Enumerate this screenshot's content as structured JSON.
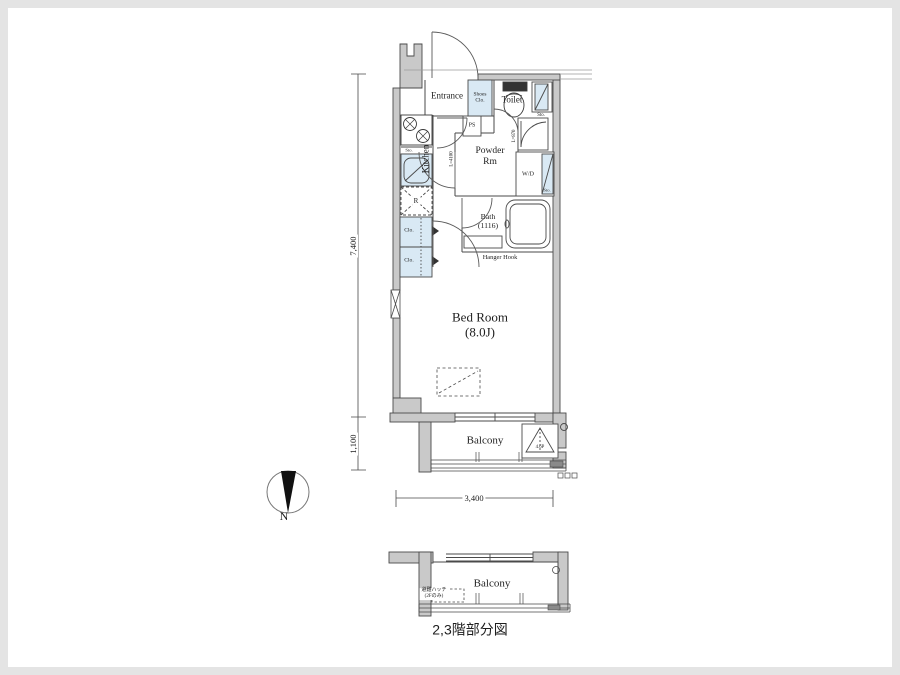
{
  "colors": {
    "wall": "#c9c9c9",
    "fixture": "#d9e9f4",
    "line": "#4a4a4a"
  },
  "main": {
    "entrance": "Entrance",
    "shoes_closet": "Shoes\nClo.",
    "toilet": "Toilet",
    "pipe_space": "PS",
    "storage_top": "Sto.",
    "storage_kitchen": "Sto.",
    "storage_wd": "Sto.",
    "kitchen": "Kitchen",
    "kitchen_length": "L=4100",
    "powder_room": "Powder\nRm",
    "washer_dryer": "W/D",
    "closet_length": "L=870",
    "bath": "Bath\n(1116)",
    "hanger_hook": "Hanger Hook",
    "closet_1": "Clo.",
    "closet_2": "Clo.",
    "refrigerator": "R",
    "bedroom": "Bed Room\n(8.0J)",
    "balcony": "Balcony",
    "hatch_label": "4.6P"
  },
  "dimensions": {
    "total_depth": "7,400",
    "balcony_depth": "1,100",
    "width": "3,400"
  },
  "compass": {
    "north": "N"
  },
  "lower": {
    "balcony": "Balcony",
    "hatch_note": "避難ハッチ\n(2Fのみ)",
    "caption": "2,3階部分図"
  }
}
